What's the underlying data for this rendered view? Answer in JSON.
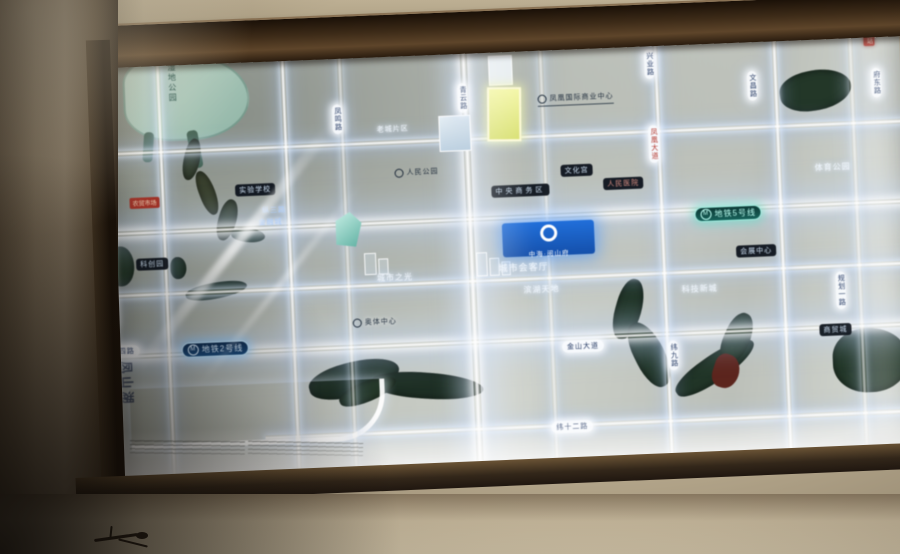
{
  "scene": {
    "kind": "backlit real-estate location map board on a wall",
    "wall_color": "#b2a489",
    "frame_color": "#3d2b18"
  },
  "map": {
    "colors": {
      "panel": "#c4c8c1",
      "road_glow": "#eaf3ff",
      "water": "#223728",
      "lake": "#a9c7b9",
      "highlight_plot": "#e6ee7c",
      "badge_blue": "#1a66d4",
      "metro_line2": "#7ec3f0",
      "metro_line5": "#7fe3d6"
    },
    "lake_label": "湿地公园",
    "watermark": "凤山湖",
    "metro_lines": [
      {
        "id": "line-2",
        "label": "地铁2号线"
      },
      {
        "id": "line-5",
        "label": "地铁5号线"
      }
    ],
    "badge": {
      "title": "中海·阅山府",
      "subtitle": "城市会客厅"
    },
    "roads_vertical_labels": [
      "凤鸣路",
      "青云路",
      "兴业路",
      "文昌路",
      "府东路",
      "纬九路",
      "规划一路",
      "滨湖路",
      "凤凰大道"
    ],
    "roads_horizontal_labels": [
      "金山大道",
      "纬四路",
      "纬十二路"
    ],
    "pois": {
      "dark": [
        "实验学校",
        "中央商务区",
        "文化宫",
        "人民医院",
        "会展中心",
        "科创园",
        "商贸城"
      ],
      "circle": [
        "凤凰国际商业中心",
        "人民公园",
        "奥体中心"
      ],
      "glow": [
        "纵三路",
        "金融城",
        "老城片区",
        "城市之光",
        "滨湖天地",
        "科技新城",
        "体育公园"
      ],
      "red": [
        "油站",
        "农贸市场"
      ]
    }
  }
}
